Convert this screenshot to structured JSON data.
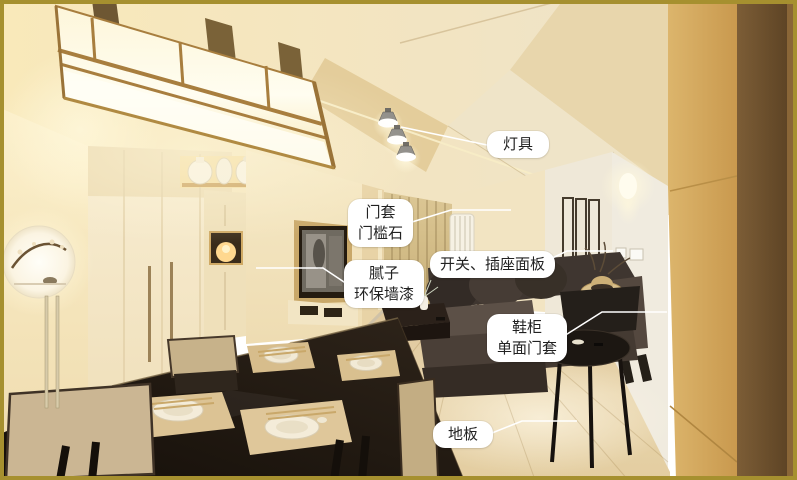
{
  "figure": {
    "border_color": "#a6902f",
    "callout_bg": "#ffffff",
    "callout_text_color": "#222222",
    "leader_line_color": "#ffffff"
  },
  "annotations": {
    "lamp": {
      "lines": [
        "灯具"
      ]
    },
    "door": {
      "lines": [
        "门套",
        "门槛石"
      ]
    },
    "switch": {
      "lines": [
        "开关、插座面板"
      ]
    },
    "putty": {
      "lines": [
        "腻子",
        "环保墙漆"
      ]
    },
    "shoe": {
      "lines": [
        "鞋柜",
        "单面门套"
      ]
    },
    "floor": {
      "lines": [
        "地板"
      ]
    }
  }
}
